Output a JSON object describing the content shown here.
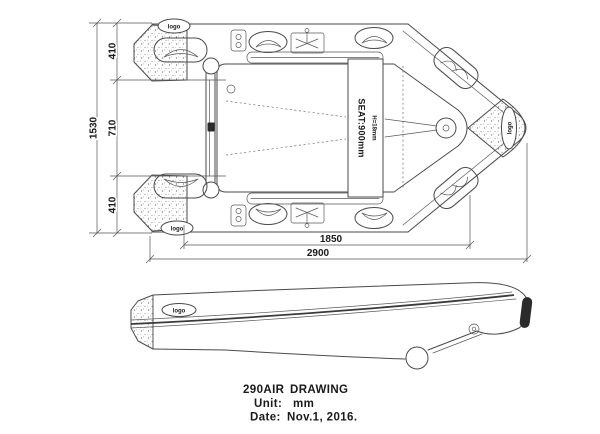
{
  "drawing_title": {
    "model": "290AIR",
    "type": "DRAWING",
    "unit_label": "Unit:",
    "unit_value": "mm",
    "date_label": "Date:",
    "date_value": "Nov.1, 2016."
  },
  "dimensions": {
    "overall_beam": "1530",
    "inner_beam": "710",
    "tube_width_top": "410",
    "tube_width_bottom": "410",
    "inner_length": "1850",
    "overall_length": "2900"
  },
  "seat": {
    "label": "SEAT:900mm",
    "sub_label": "H=18mm"
  },
  "labels": {
    "logo": "logo"
  },
  "colors": {
    "line": "#4a4a4a",
    "text": "#1a1a1a",
    "background": "#ffffff"
  }
}
